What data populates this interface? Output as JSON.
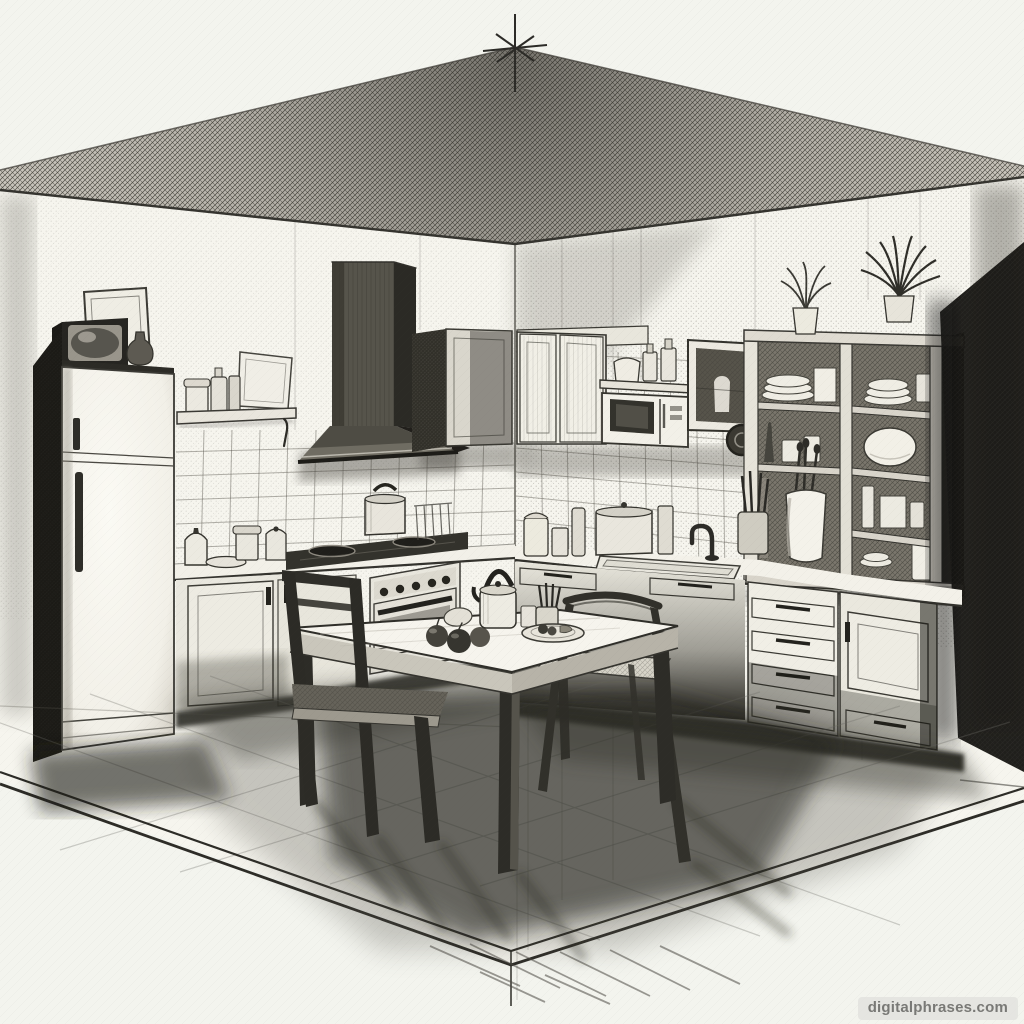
{
  "image": {
    "kind": "pencil-sketch-illustration",
    "subject": "Black-and-white pencil sketch of a kitchen interior in two-point perspective",
    "medium": "graphite pencil on off-white paper"
  },
  "watermark": {
    "text": "digitalphrases.com"
  },
  "palette": {
    "paper": "#f3f4ee",
    "graphite_dark": "#23221d",
    "graphite_mid": "#55534b",
    "graphite_light": "#8d8a81",
    "watermark_bg": "#e4e4e0",
    "watermark_text": "#6f6f6c"
  },
  "scene": {
    "perspective": "two-point interior corner with apex mark at top center",
    "objects": [
      "refrigerator",
      "television-on-refrigerator",
      "leaning-picture-frame",
      "vase",
      "wall-shelf-with-bottles",
      "leaning-cutting-board",
      "tiled-backsplash",
      "range-hood",
      "gas-cooktop",
      "pot-on-stove",
      "oven-with-knobs",
      "dish-rack",
      "upper-cabinets",
      "microwave-with-shelf",
      "glass-front-cabinet",
      "wall-plate",
      "open-shelving-unit",
      "stacked-plates",
      "large-bowl",
      "jar-with-utensils",
      "potted-plant-small",
      "potted-plant-large",
      "sink-with-faucet",
      "counter-canisters",
      "drawer-stack",
      "base-cabinets",
      "dining-table",
      "chair-left",
      "chair-right",
      "fruits",
      "kettle",
      "serving-tray",
      "utensil-cup",
      "tiled-floor",
      "cast-shadows",
      "perspective-apex-mark"
    ]
  }
}
